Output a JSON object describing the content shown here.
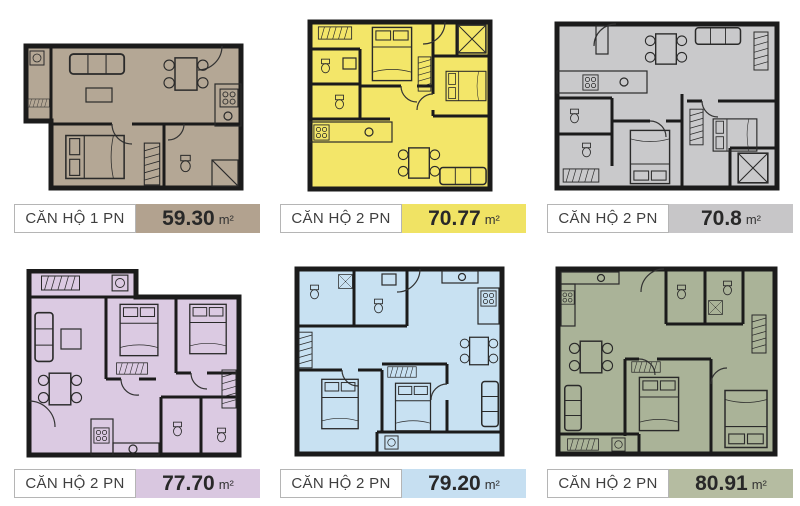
{
  "page": {
    "background": "#ffffff",
    "wall_color": "#1b1b1b"
  },
  "plan_icons": [
    "bed-icon",
    "dining-table-icon",
    "sofa-icon",
    "toilet-icon",
    "stove-icon",
    "washer-icon",
    "wardrobe-icon",
    "balcony-cross-icon",
    "door-arc-icon",
    "sink-icon"
  ],
  "units": [
    {
      "name": "CĂN HỘ 1 PN",
      "area": "59.30",
      "unit": "m²",
      "plan_color": "#b4a795",
      "label_color": "#b2a28f"
    },
    {
      "name": "CĂN HỘ 2 PN",
      "area": "70.77",
      "unit": "m²",
      "plan_color": "#f3e669",
      "label_color": "#f0e364"
    },
    {
      "name": "CĂN HỘ 2 PN",
      "area": "70.8",
      "unit": "m²",
      "plan_color": "#c9c9cb",
      "label_color": "#c7c6c8"
    },
    {
      "name": "CĂN HỘ 2 PN",
      "area": "77.70",
      "unit": "m²",
      "plan_color": "#dbcae2",
      "label_color": "#d9c7e0"
    },
    {
      "name": "CĂN HỘ 2 PN",
      "area": "79.20",
      "unit": "m²",
      "plan_color": "#c8e1f2",
      "label_color": "#c6dff1"
    },
    {
      "name": "CĂN HỘ 2 PN",
      "area": "80.91",
      "unit": "m²",
      "plan_color": "#aab398",
      "label_color": "#b5bca1"
    }
  ]
}
